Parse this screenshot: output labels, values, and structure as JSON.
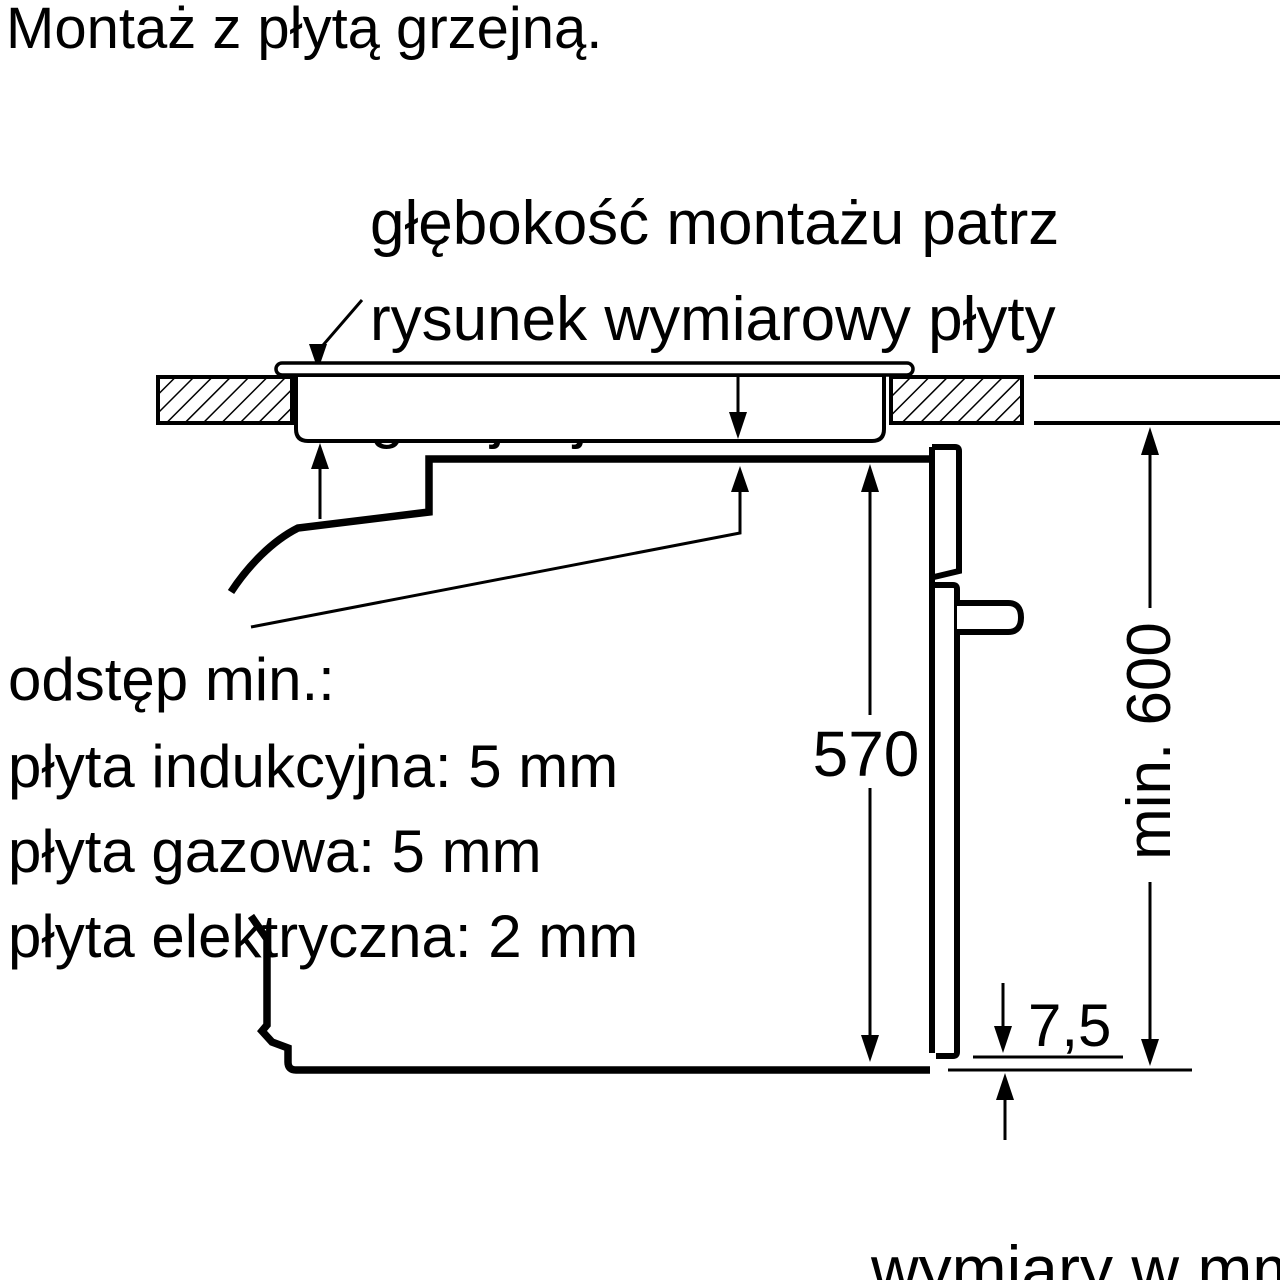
{
  "title": "Montaż z płytą grzejną.",
  "annotation": {
    "line1": "głębokość montażu patrz",
    "line2": "rysunek wymiarowy płyty",
    "line3": "grzejnej"
  },
  "clearance": {
    "line1": "odstęp min.:",
    "line2": "płyta indukcyjna: 5 mm",
    "line3": "płyta gazowa: 5 mm",
    "line4": "płyta elektryczna: 2 mm"
  },
  "dimensions": {
    "oven_height": "570",
    "min_niche_height": "min. 600",
    "door_bottom_gap": "7,5"
  },
  "footer_note": "wymiary w mm",
  "colors": {
    "line": "#000000",
    "background": "#ffffff"
  }
}
